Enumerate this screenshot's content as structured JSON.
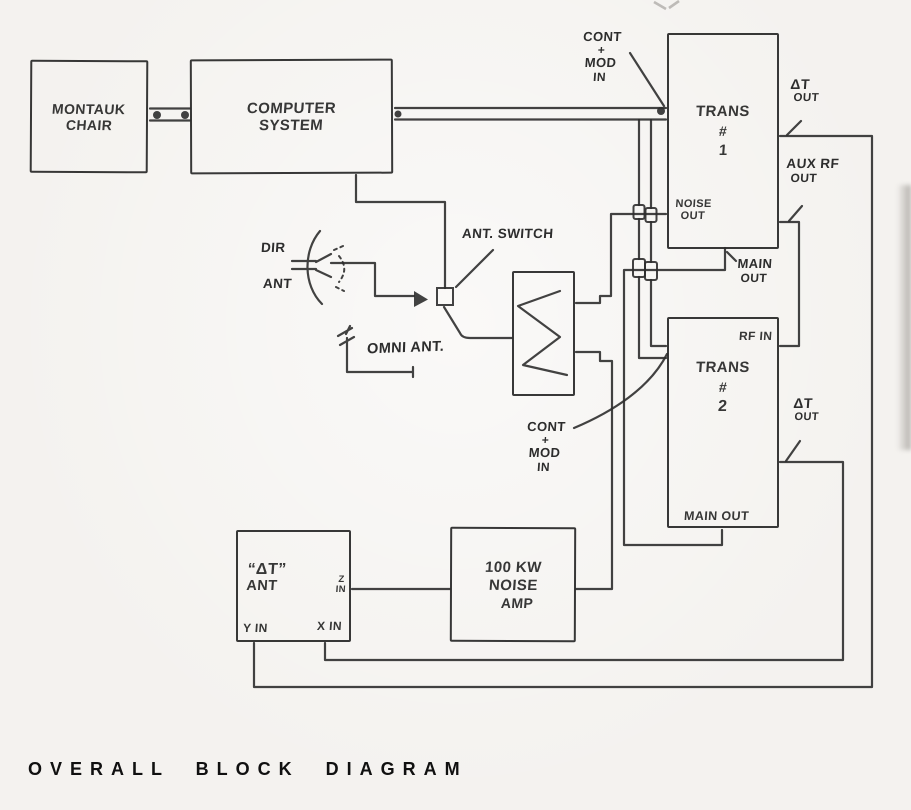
{
  "colors": {
    "ink": "#2d2d2d",
    "paper": "#f4f2ef",
    "title": "#101010"
  },
  "title": "OVERALL BLOCK DIAGRAM",
  "boxes": {
    "montauk_chair": {
      "lines": [
        "MONTAUK",
        "CHAIR"
      ]
    },
    "computer_system": {
      "lines": [
        "COMPUTER",
        "SYSTEM"
      ]
    },
    "trans_1": {
      "lines": [
        "TRANS",
        "#",
        "1"
      ]
    },
    "trans_2": {
      "lines": [
        "TRANS",
        "#",
        "2"
      ]
    },
    "noise_amp": {
      "lines": [
        "100 KW",
        "NOISE",
        "AMP"
      ]
    },
    "delta_t_ant": {
      "lines": [
        "“ΔT”",
        "ANT"
      ]
    }
  },
  "ports": {
    "trans1_noise_out": {
      "lines": [
        "NOISE",
        "OUT"
      ]
    },
    "trans1_main_out": {
      "lines": [
        "MAIN",
        "OUT"
      ]
    },
    "trans1_delta_t_out": {
      "lines": [
        "ΔT",
        "OUT"
      ]
    },
    "trans1_aux_rf_out": {
      "lines": [
        "AUX RF",
        "OUT"
      ]
    },
    "trans2_rf_in": "RF IN",
    "trans2_main_out": "MAIN OUT",
    "trans2_delta_t_out": {
      "lines": [
        "ΔT",
        "OUT"
      ]
    },
    "ant_z_in": {
      "lines": [
        "Z",
        "IN"
      ]
    },
    "ant_y_in": "Y IN",
    "ant_x_in": "X IN",
    "cont_mod_in_top": {
      "lines": [
        "CONT",
        "+",
        "MOD",
        "IN"
      ]
    },
    "cont_mod_in_bottom": {
      "lines": [
        "CONT",
        "+",
        "MOD",
        "IN"
      ]
    }
  },
  "annotations": {
    "ant_switch": "ANT. SWITCH",
    "omni_ant": "OMNI ANT.",
    "dir_ant": {
      "lines": [
        "DIR",
        "ANT"
      ]
    }
  }
}
